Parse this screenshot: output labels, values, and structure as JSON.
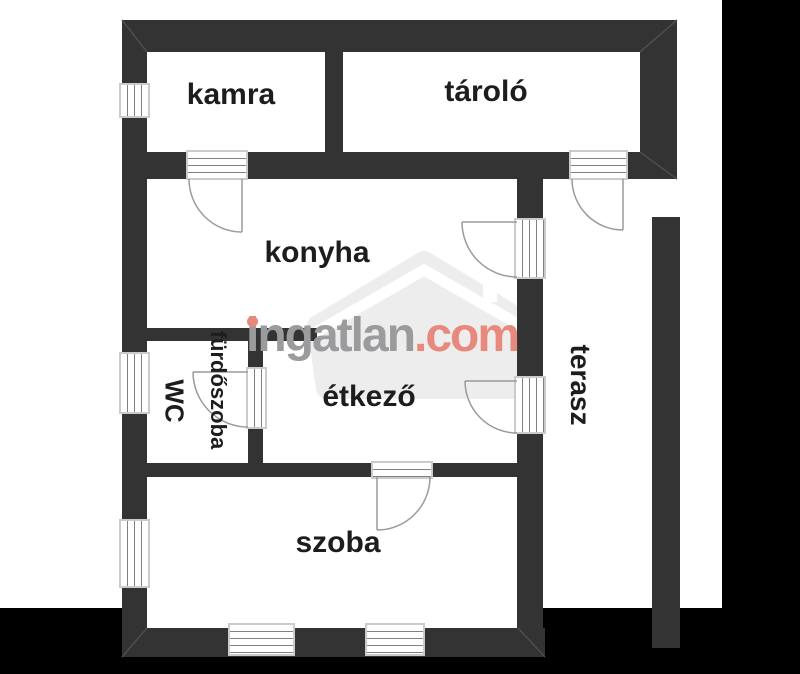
{
  "rooms": [
    {
      "label": "kamra"
    },
    {
      "label": "tároló"
    },
    {
      "label": "konyha"
    },
    {
      "label": "WC"
    },
    {
      "label": "fürdőszoba"
    },
    {
      "label": "étkező"
    },
    {
      "label": "szoba"
    },
    {
      "label": "terasz"
    }
  ],
  "watermark": {
    "brand_gray": "ingatlan",
    "brand_accent": ".com"
  },
  "colors": {
    "wall": "#333333",
    "label_text": "#1d1d1d",
    "watermark_gray": "#9b9b9e",
    "watermark_accent": "#e8897e",
    "logo_gray": "#ededee",
    "frame_gray": "#cbcbcb",
    "background": "#000000",
    "paper": "#ffffff"
  }
}
